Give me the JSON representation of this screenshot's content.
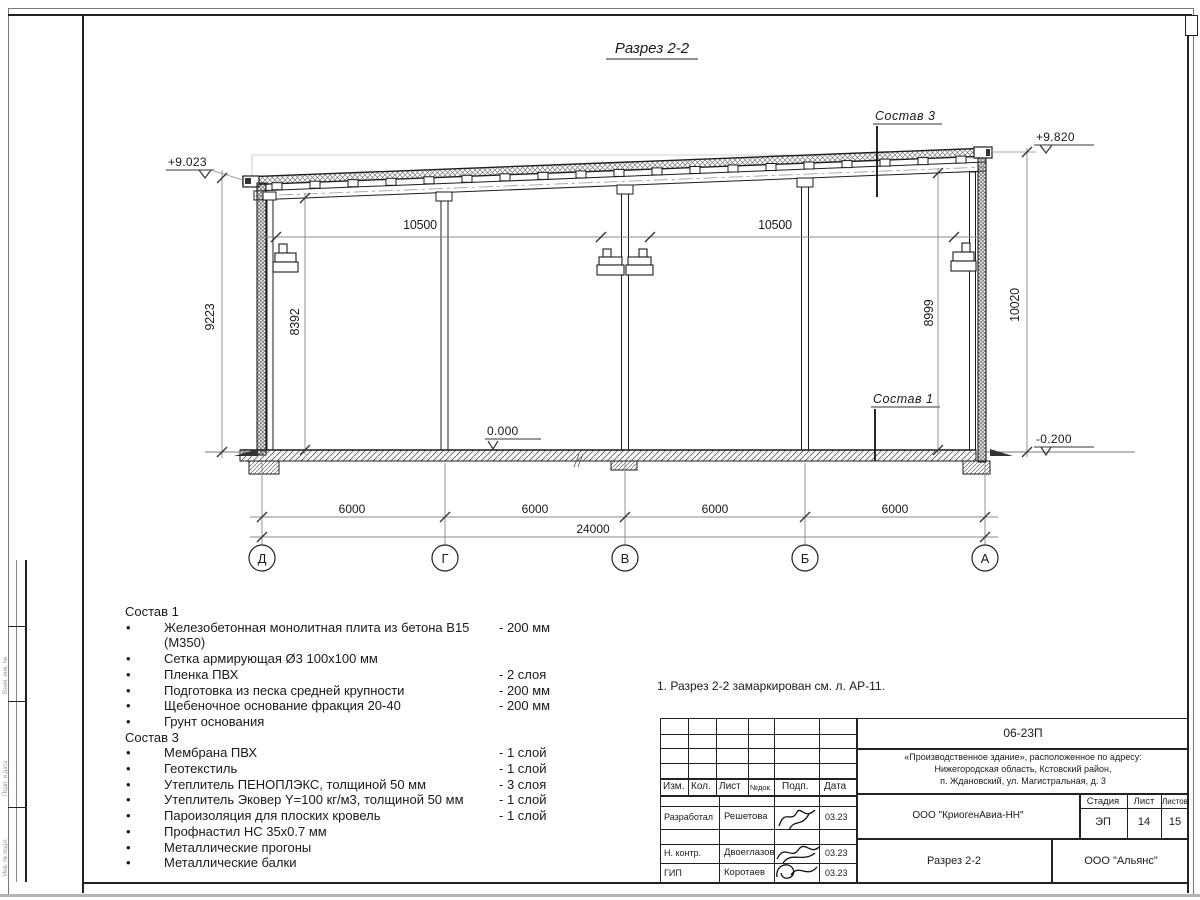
{
  "title": "Разрез 2-2",
  "drawing": {
    "elevations": {
      "left_top": "+9.023",
      "right_top": "+9.820",
      "floor": "0.000",
      "ground": "-0.200"
    },
    "labels": {
      "sostav3": "Состав 3",
      "sostav1": "Состав 1"
    },
    "dims": {
      "span_left": "10500",
      "span_right": "10500",
      "v_left_outer": "9223",
      "v_left_inner": "8392",
      "v_right_inner": "8999",
      "v_right_outer": "10020",
      "bays": [
        "6000",
        "6000",
        "6000",
        "6000"
      ],
      "total": "24000"
    },
    "axes": [
      "Д",
      "Г",
      "В",
      "Б",
      "А"
    ]
  },
  "lists": {
    "sostav1": {
      "header": "Состав 1",
      "items": [
        {
          "t": "Железобетонная монолитная плита из бетона В15 (М350)",
          "v": "-  200 мм"
        },
        {
          "t": "Сетка армирующая Ø3 100х100 мм",
          "v": ""
        },
        {
          "t": "Пленка ПВХ",
          "v": "-  2 слоя"
        },
        {
          "t": "Подготовка из песка средней крупности",
          "v": "- 200 мм"
        },
        {
          "t": "Щебеночное основание фракция 20-40",
          "v": "- 200 мм"
        },
        {
          "t": "Грунт основания",
          "v": ""
        }
      ]
    },
    "sostav3": {
      "header": "Состав 3",
      "items": [
        {
          "t": "Мембрана ПВХ",
          "v": "- 1 слой"
        },
        {
          "t": "Геотекстиль",
          "v": "- 1 слой"
        },
        {
          "t": "Утеплитель ПЕНОПЛЭКС, толщиной 50 мм",
          "v": "- 3 слоя"
        },
        {
          "t": "Утеплитель Эковер Y=100 кг/м3, толщиной 50 мм",
          "v": "- 1 слой"
        },
        {
          "t": "Пароизоляция для плоских кровель",
          "v": "- 1 слой"
        },
        {
          "t": "Профнастил НС 35х0.7 мм",
          "v": ""
        },
        {
          "t": "Металлические прогоны",
          "v": ""
        },
        {
          "t": "Металлические балки",
          "v": ""
        }
      ]
    }
  },
  "note": "1. Разрез 2-2 замаркирован см. л. АР-11.",
  "titleblock": {
    "doc_number": "06-23П",
    "project_line1": "«Производственное здание», расположенное по адресу:",
    "project_line2": "Нижегородская область, Кстовский район,",
    "project_line3": "п. Ждановский, ул. Магистральная, д. 3",
    "header_cols": {
      "izm": "Изм.",
      "kol": "Кол.",
      "list": "Лист",
      "ndok": "№док.",
      "podp": "Подп.",
      "data": "Дата"
    },
    "rows": [
      {
        "role": "Разработал",
        "name": "Решетова",
        "date": "03.23"
      },
      {
        "role": "Н. контр.",
        "name": "Двоеглазов",
        "date": "03.23"
      },
      {
        "role": "ГИП",
        "name": "Коротаев",
        "date": "03.23"
      }
    ],
    "company": "ООО \"КриогенАвиа-НН\"",
    "stage_label": "Стадия",
    "sheet_label": "Лист",
    "sheets_label": "Листов",
    "stage": "ЭП",
    "sheet": "14",
    "sheets": "15",
    "drawing_name": "Разрез 2-2",
    "org": "ООО \"Альянс\""
  },
  "left_stub": {
    "cell1": "Взам. инв. №",
    "cell2": "Подп. и дата",
    "cell3": "Инв. № подл."
  }
}
